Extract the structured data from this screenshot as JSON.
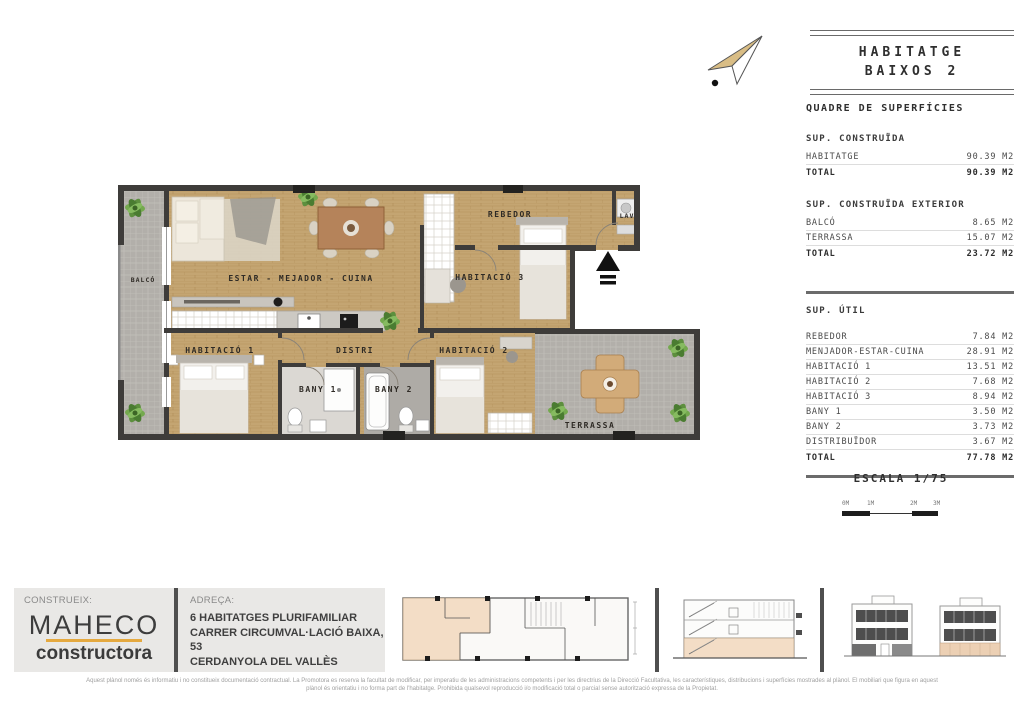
{
  "title_box": {
    "line1": "HABITATGE",
    "line2": "BAIXOS 2"
  },
  "surface_table": {
    "title": "QUADRE DE SUPERFÍCIES",
    "sections": [
      {
        "header": "SUP. CONSTRUÏDA",
        "rows": [
          {
            "label": "HABITATGE",
            "value": "90.39 M2"
          }
        ],
        "total": {
          "label": "TOTAL",
          "value": "90.39 M2"
        }
      },
      {
        "header": "SUP. CONSTRUÏDA EXTERIOR",
        "rows": [
          {
            "label": "BALCÓ",
            "value": "8.65 M2"
          },
          {
            "label": "TERRASSA",
            "value": "15.07 M2"
          }
        ],
        "total": {
          "label": "TOTAL",
          "value": "23.72 M2"
        }
      },
      {
        "header": "SUP. ÚTIL",
        "rows": [
          {
            "label": "REBEDOR",
            "value": "7.84 M2"
          },
          {
            "label": "MENJADOR-ESTAR-CUINA",
            "value": "28.91 M2"
          },
          {
            "label": "HABITACIÓ 1",
            "value": "13.51 M2"
          },
          {
            "label": "HABITACIÓ 2",
            "value": "7.68 M2"
          },
          {
            "label": "HABITACIÓ 3",
            "value": "8.94 M2"
          },
          {
            "label": "BANY 1",
            "value": "3.50 M2"
          },
          {
            "label": "BANY 2",
            "value": "3.73 M2"
          },
          {
            "label": "DISTRIBUÏDOR",
            "value": "3.67 M2"
          }
        ],
        "total": {
          "label": "TOTAL",
          "value": "77.78 M2"
        }
      }
    ]
  },
  "scale": {
    "label": "ESCALA 1/75",
    "ticks": [
      "0M",
      "1M",
      "2M",
      "3M"
    ]
  },
  "plan_rooms": {
    "balco": "BALCÓ",
    "estar": "ESTAR - MEJADOR - CUINA",
    "rebedor": "REBEDOR",
    "lav": "LAV",
    "hab3": "HABITACIÓ 3",
    "hab1": "HABITACIÓ 1",
    "distri": "DISTRI",
    "hab2": "HABITACIÓ 2",
    "bany1": "BANY 1",
    "bany2": "BANY 2",
    "terrassa": "TERRASSA"
  },
  "footer": {
    "construeix_label": "CONSTRUEIX:",
    "brand_name": "MAHECO",
    "brand_sub": "constructora",
    "adreca_label": "ADREÇA:",
    "address_line1": "6 HABITATGES PLURIFAMILIAR",
    "address_line2": "CARRER CIRCUMVAL·LACIÓ BAIXA, 53",
    "address_line3": "CERDANYOLA DEL VALLÈS"
  },
  "disclaimer": {
    "line1": "Aquest plànol només és informatiu i no constitueix documentació contractual. La Promotora es reserva la facultat de modificar, per imperatiu de les administracions competents i per les directrius de la Direcció Facultativa, les característiques, distribucions i superfícies mostrades al plànol. El mobiliari que figura en aquest",
    "line2": "plànol és orientatiu i no forma part de l'habitatge. Prohibida qualsevol reproducció i/o modificació total o parcial sense autorització expressa de la Propietat."
  },
  "colors": {
    "wood_floor": "#c4a572",
    "tile_gray": "#b2afaa",
    "wall_dark": "#3e3c3a",
    "brand_accent": "#e5a93f",
    "unit_highlight": "#f3ddc6"
  }
}
